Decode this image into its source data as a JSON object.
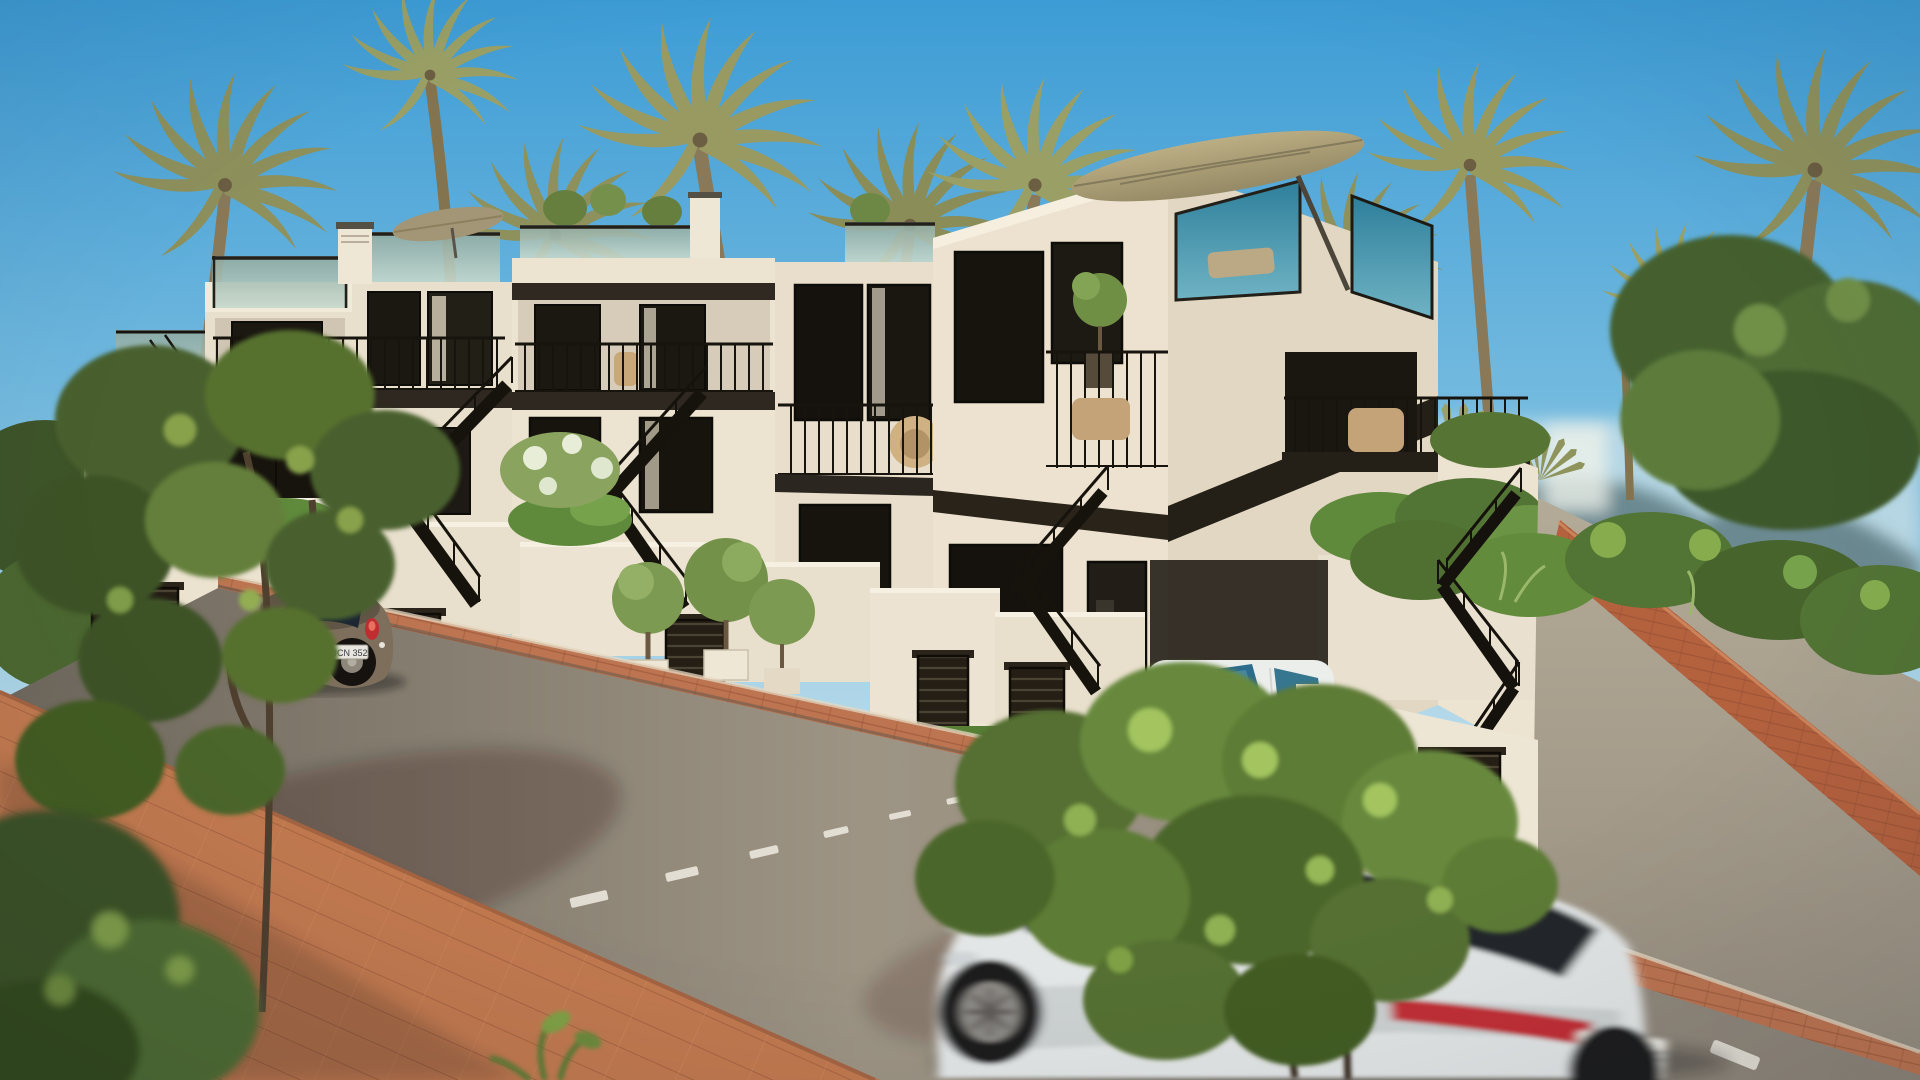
{
  "scene": {
    "type": "architectural-3d-render",
    "description": "Row of four modern white new-build townhouses with rooftop terraces on a sunny palm-lined street; street slopes down to the left, a ramp road climbs to the right",
    "time_of_day": "daytime",
    "weather": "clear blue sky"
  },
  "palette": {
    "sky_top": "#3d9cd5",
    "sky_horizon": "#e8f1f1",
    "facade_cream": "#ece3d1",
    "facade_shadow": "#d8cebb",
    "fascia_dark_brown": "#2e2820",
    "railing_black": "#17130d",
    "glass_green": "#a9c0b4",
    "glass_teal": "#2e7f9b",
    "hedge_green": "#5f8a3c",
    "palm_olive": "#8e915c",
    "road_asphalt": "#948b7d",
    "brick_terracotta": "#bd7450",
    "umbrella_tan": "#b0a379"
  },
  "buildings": {
    "count": 4,
    "style": "modern Mediterranean townhouses",
    "features": [
      "rooftop terraces with glass balustrades",
      "tan patio umbrellas on roof terraces",
      "black metal balcony railings with rattan chairs",
      "external black zigzag staircases",
      "dark slatted garage vents in white street walls",
      "potted olive trees and trimmed hedges",
      "dark brown fascia bands",
      "white chimneys"
    ]
  },
  "vehicles": {
    "beetle": {
      "type": "compact coupe, parked on left side of street",
      "color": "brown-grey",
      "plate": "UCN 352"
    },
    "hatchback": {
      "type": "compact car parked in driveway behind slatted gate",
      "color": "white"
    },
    "suv": {
      "type": "large SUV driving through foreground, motion-blurred",
      "color": "white with black glass roof",
      "plate": "GC 708P"
    }
  },
  "street": {
    "surface": "asphalt",
    "marking": "dashed white centre line",
    "sidewalk": "terracotta brick pavers",
    "right_side": "brick-edged ramp road climbing uphill"
  },
  "vegetation": {
    "palm_trees": 10,
    "foreground_trees": 3,
    "hedges": "trimmed green hedges and ivy",
    "background": "dense shrubs and distant hills"
  }
}
